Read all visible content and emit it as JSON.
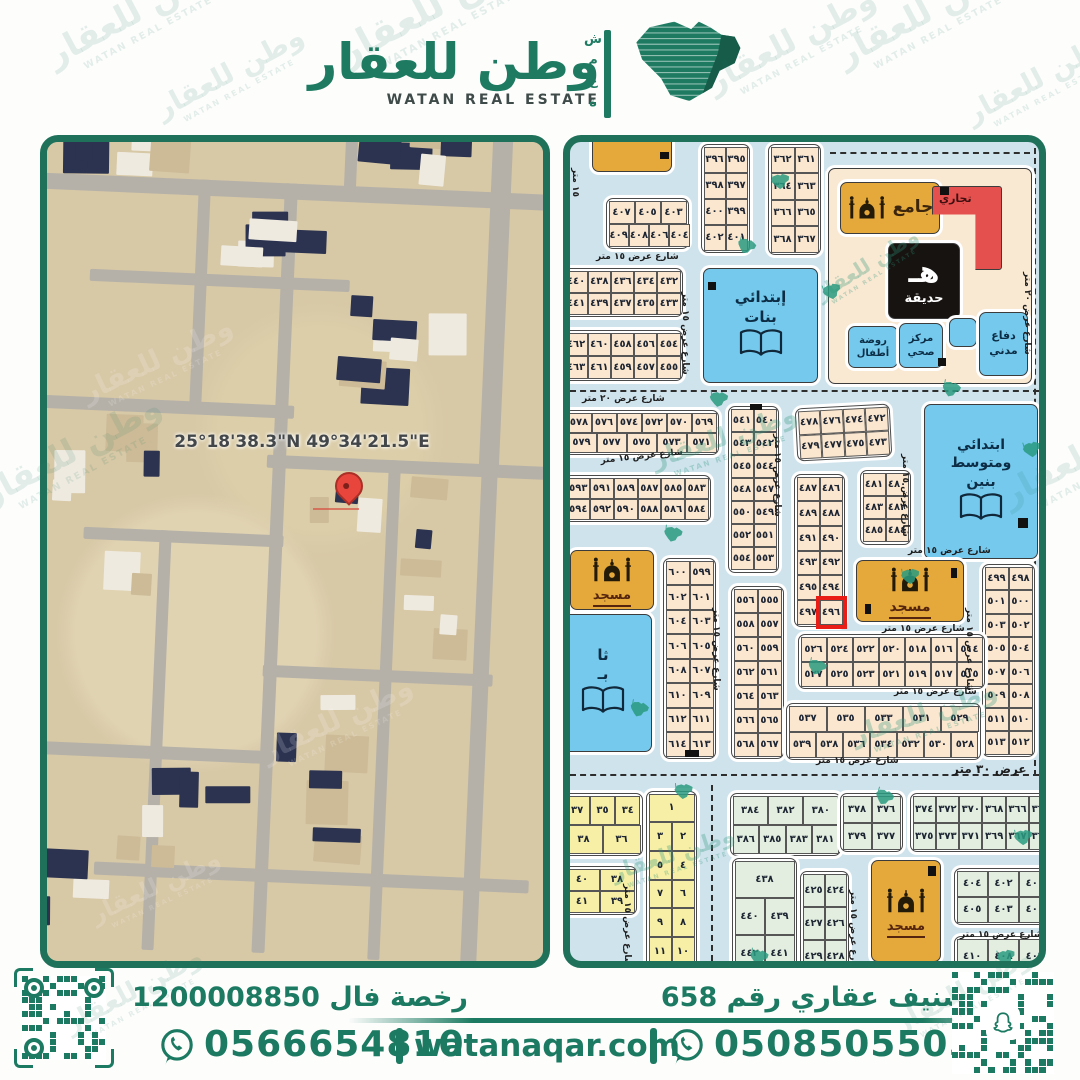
{
  "brand": {
    "name_ar": "وطن للعقار",
    "name_en": "WATAN REAL ESTATE",
    "side_letters": [
      "ش",
      "م",
      "ع",
      "ة"
    ]
  },
  "satellite": {
    "coordinates": "25°18'38.3\"N 49°34'21.5\"E"
  },
  "plot_map": {
    "highlighted_plot": "٤٩٦",
    "facilities": [
      {
        "id": "gold-top",
        "color": "gold",
        "icon": "",
        "lines": [],
        "x": 22,
        "y": -8,
        "w": 78,
        "h": 36,
        "fs": 10
      },
      {
        "id": "services-superblock",
        "color": "cream",
        "icon": "",
        "lines": [],
        "x": 258,
        "y": 26,
        "w": 202,
        "h": 214,
        "fs": 10
      },
      {
        "id": "jami",
        "color": "gold",
        "icon": "mosque",
        "row": true,
        "lines": [
          "جامع"
        ],
        "x": 270,
        "y": 40,
        "w": 98,
        "h": 50,
        "fs": 17
      },
      {
        "id": "tejari",
        "color": "red",
        "icon": "",
        "shape": "L",
        "lines": [
          "تجاري"
        ],
        "x": 362,
        "y": 44,
        "w": 62,
        "h": 76,
        "fs": 11
      },
      {
        "id": "hadiqah",
        "color": "black",
        "icon": "ha",
        "lines": [
          "حديقة"
        ],
        "x": 318,
        "y": 101,
        "w": 70,
        "h": 74,
        "fs": 13
      },
      {
        "id": "rawda",
        "color": "blue",
        "icon": "",
        "lines": [
          "روضة",
          "أطفال"
        ],
        "x": 278,
        "y": 184,
        "w": 48,
        "h": 40,
        "fs": 10
      },
      {
        "id": "markaz",
        "color": "blue",
        "icon": "",
        "lines": [
          "مركز",
          "صحي"
        ],
        "x": 329,
        "y": 181,
        "w": 42,
        "h": 43,
        "fs": 10
      },
      {
        "id": "blue-small",
        "color": "blue",
        "icon": "",
        "lines": [],
        "x": 379,
        "y": 176,
        "w": 26,
        "h": 27,
        "fs": 9
      },
      {
        "id": "difa",
        "color": "blue",
        "icon": "",
        "lines": [
          "دفاع",
          "مدني"
        ],
        "x": 409,
        "y": 170,
        "w": 47,
        "h": 62,
        "fs": 11
      },
      {
        "id": "school-banat",
        "color": "blue",
        "icon": "book",
        "lines": [
          "إبتدائي",
          "بنات"
        ],
        "x": 133,
        "y": 126,
        "w": 113,
        "h": 113,
        "fs": 15
      },
      {
        "id": "school-banin",
        "color": "blue",
        "icon": "book",
        "lines": [
          "ابتدائي",
          "ومتوسط",
          "بنين"
        ],
        "x": 354,
        "y": 262,
        "w": 112,
        "h": 153,
        "fs": 14
      },
      {
        "id": "mosque-mid",
        "color": "gold",
        "icon": "mosque",
        "lines": [
          "مسجد"
        ],
        "x": 286,
        "y": 418,
        "w": 106,
        "h": 60,
        "fs": 14
      },
      {
        "id": "mosque-left",
        "color": "gold",
        "icon": "mosque",
        "lines": [
          "مسجد"
        ],
        "x": 0,
        "y": 408,
        "w": 82,
        "h": 58,
        "fs": 13
      },
      {
        "id": "school-partial",
        "color": "blue",
        "icon": "book",
        "lines": [
          "ثا",
          "بـ"
        ],
        "x": -16,
        "y": 472,
        "w": 96,
        "h": 136,
        "fs": 15
      },
      {
        "id": "mosque-bottom",
        "color": "gold",
        "icon": "mosque",
        "lines": [
          "مسجد"
        ],
        "x": 301,
        "y": 718,
        "w": 68,
        "h": 100,
        "fs": 13
      }
    ],
    "blocks": [
      {
        "x": 36,
        "y": 56,
        "w": 78,
        "h": 46,
        "c": "cream",
        "rows": [
          [
            "٤٠٧",
            "٤٠٥",
            "٤٠٣"
          ],
          [
            "٤٠٩",
            "٤٠٨",
            "٤٠٦",
            "٤٠٤"
          ]
        ]
      },
      {
        "x": 131,
        "y": 2,
        "w": 44,
        "h": 104,
        "c": "cream",
        "rows": [
          [
            "٣٩٦",
            "٣٩٥"
          ],
          [
            "٣٩٨",
            "٣٩٧"
          ],
          [
            "٤٠٠",
            "٣٩٩"
          ],
          [
            "٤٠٢",
            "٤٠١"
          ]
        ]
      },
      {
        "x": 198,
        "y": 2,
        "w": 48,
        "h": 106,
        "c": "cream",
        "rows": [
          [
            "٣٦٢",
            "٣٦١"
          ],
          [
            "٣٦٤",
            "٣٦٣"
          ],
          [
            "٣٦٦",
            "٣٦٥"
          ],
          [
            "٣٦٨",
            "٣٦٧"
          ]
        ]
      },
      {
        "x": -8,
        "y": 126,
        "w": 116,
        "h": 44,
        "c": "cream",
        "rows": [
          [
            "٤٤٠",
            "٤٣٨",
            "٤٣٦",
            "٤٣٤",
            "٤٣٢"
          ],
          [
            "٤٤١",
            "٤٣٩",
            "٤٣٧",
            "٤٣٥",
            "٤٣٣"
          ]
        ]
      },
      {
        "x": -8,
        "y": 188,
        "w": 116,
        "h": 46,
        "c": "cream",
        "rows": [
          [
            "٤٦٢",
            "٤٦٠",
            "٤٥٨",
            "٤٥٦",
            "٤٥٤"
          ],
          [
            "٤٦٣",
            "٤٦١",
            "٤٥٩",
            "٤٥٧",
            "٤٥٥"
          ]
        ]
      },
      {
        "x": -6,
        "y": 268,
        "w": 150,
        "h": 40,
        "c": "cream",
        "rows": [
          [
            "٥٧٨",
            "٥٧٦",
            "٥٧٤",
            "٥٧٢",
            "٥٧٠",
            "٥٦٩"
          ],
          [
            "٥٧٩",
            "٥٧٧",
            "٥٧٥",
            "٥٧٣",
            "٥٧١"
          ]
        ]
      },
      {
        "x": -6,
        "y": 333,
        "w": 142,
        "h": 42,
        "c": "cream",
        "rows": [
          [
            "٥٩٣",
            "٥٩١",
            "٥٨٩",
            "٥٨٧",
            "٥٨٥",
            "٥٨٣"
          ],
          [
            "٥٩٤",
            "٥٩٢",
            "٥٩٠",
            "٥٨٨",
            "٥٨٦",
            "٥٨٤"
          ]
        ]
      },
      {
        "x": 158,
        "y": 264,
        "w": 46,
        "h": 162,
        "c": "cream",
        "rows": [
          [
            "٥٤١",
            "٥٤٠"
          ],
          [
            "٥٤٣",
            "٥٤٢"
          ],
          [
            "٥٤٥",
            "٥٤٤"
          ],
          [
            "٥٤٨",
            "٥٤٧"
          ],
          [
            "٥٥٠",
            "٥٤٩"
          ],
          [
            "٥٥٢",
            "٥٥١"
          ],
          [
            "٥٥٤",
            "٥٥٣"
          ]
        ]
      },
      {
        "x": 226,
        "y": 264,
        "w": 90,
        "h": 48,
        "c": "cream",
        "rot": -3,
        "rows": [
          [
            "٤٧٨",
            "٤٧٦",
            "٤٧٤",
            "٤٧٢"
          ],
          [
            "٤٧٩",
            "٤٧٧",
            "٤٧٥",
            "٤٧٣"
          ]
        ]
      },
      {
        "x": 290,
        "y": 328,
        "w": 46,
        "h": 70,
        "c": "cream",
        "rows": [
          [
            "٤٨١",
            "٤٨٠"
          ],
          [
            "٤٨٣",
            "٤٨٢"
          ],
          [
            "٤٨٥",
            "٤٨٤"
          ]
        ]
      },
      {
        "x": 224,
        "y": 332,
        "w": 46,
        "h": 148,
        "c": "cream",
        "hl": "٤٩٦",
        "rows": [
          [
            "٤٨٧",
            "٤٨٦"
          ],
          [
            "٤٨٩",
            "٤٨٨"
          ],
          [
            "٤٩١",
            "٤٩٠"
          ],
          [
            "٤٩٣",
            "٤٩٢"
          ],
          [
            "٤٩٥",
            "٤٩٤"
          ],
          [
            "٤٩٧",
            "٤٩٦"
          ]
        ]
      },
      {
        "x": 412,
        "y": 422,
        "w": 48,
        "h": 188,
        "c": "cream",
        "rows": [
          [
            "٤٩٩",
            "٤٩٨"
          ],
          [
            "٥٠١",
            "٥٠٠"
          ],
          [
            "٥٠٣",
            "٥٠٢"
          ],
          [
            "٥٠٥",
            "٥٠٤"
          ],
          [
            "٥٠٧",
            "٥٠٦"
          ],
          [
            "٥٠٩",
            "٥٠٨"
          ],
          [
            "٥١١",
            "٥١٠"
          ],
          [
            "٥١٣",
            "٥١٢"
          ]
        ]
      },
      {
        "x": 161,
        "y": 444,
        "w": 48,
        "h": 168,
        "c": "cream",
        "rows": [
          [
            "٥٥٦",
            "٥٥٥"
          ],
          [
            "٥٥٨",
            "٥٥٧"
          ],
          [
            "٥٦٠",
            "٥٥٩"
          ],
          [
            "٥٦٢",
            "٥٦١"
          ],
          [
            "٥٦٤",
            "٥٦٣"
          ],
          [
            "٥٦٦",
            "٥٦٥"
          ],
          [
            "٥٦٨",
            "٥٦٧"
          ]
        ]
      },
      {
        "x": 93,
        "y": 416,
        "w": 48,
        "h": 196,
        "c": "cream",
        "rows": [
          [
            "٦٠٠",
            "٥٩٩"
          ],
          [
            "٦٠٢",
            "٦٠١"
          ],
          [
            "٦٠٤",
            "٦٠٣"
          ],
          [
            "٦٠٦",
            "٦٠٥"
          ],
          [
            "٦٠٨",
            "٦٠٧"
          ],
          [
            "٦١٠",
            "٦٠٩"
          ],
          [
            "٦١٢",
            "٦١١"
          ],
          [
            "٦١٤",
            "٦١٣"
          ]
        ]
      },
      {
        "x": 228,
        "y": 492,
        "w": 182,
        "h": 50,
        "c": "cream",
        "rows": [
          [
            "٥٢٦",
            "٥٢٤",
            "٥٢٢",
            "٥٢٠",
            "٥١٨",
            "٥١٦",
            "٥١٤"
          ],
          [
            "٥٢٧",
            "٥٢٥",
            "٥٢٣",
            "٥٢١",
            "٥١٩",
            "٥١٧",
            "٥١٥"
          ]
        ]
      },
      {
        "x": 216,
        "y": 561,
        "w": 190,
        "h": 52,
        "c": "cream",
        "rows": [
          [
            "٥٣٧",
            "٥٣٥",
            "٥٣٣",
            "٥٣١",
            "٥٢٩"
          ],
          [
            "٥٣٩",
            "٥٣٨",
            "٥٣٦",
            "٥٣٤",
            "٥٣٢",
            "٥٣٠",
            "٥٢٨"
          ]
        ]
      },
      {
        "x": -8,
        "y": 651,
        "w": 76,
        "h": 58,
        "c": "yellow",
        "rows": [
          [
            "٣٧",
            "٣٥",
            "٣٤"
          ],
          [
            "٣٨",
            "٣٦"
          ]
        ]
      },
      {
        "x": -8,
        "y": 724,
        "w": 70,
        "h": 44,
        "c": "yellow",
        "rows": [
          [
            "٤٠",
            "٣٨"
          ],
          [
            "٤١",
            "٣٩"
          ]
        ]
      },
      {
        "x": 76,
        "y": 649,
        "w": 46,
        "h": 172,
        "c": "yellow",
        "rows": [
          [
            "١"
          ],
          [
            "٣",
            "٢"
          ],
          [
            "٥",
            "٤"
          ],
          [
            "٧",
            "٦"
          ],
          [
            "٩",
            "٨"
          ],
          [
            "١١",
            "١٠"
          ]
        ]
      },
      {
        "x": 160,
        "y": 651,
        "w": 106,
        "h": 58,
        "c": "green",
        "rows": [
          [
            "٣٨٤",
            "٣٨٢",
            "٣٨٠"
          ],
          [
            "٣٨٦",
            "٣٨٥",
            "٣٨٣",
            "٣٨١"
          ]
        ]
      },
      {
        "x": 270,
        "y": 651,
        "w": 58,
        "h": 54,
        "c": "green",
        "rows": [
          [
            "٣٧٨",
            "٣٧٦"
          ],
          [
            "٣٧٩",
            "٣٧٧"
          ]
        ]
      },
      {
        "x": 340,
        "y": 651,
        "w": 140,
        "h": 54,
        "c": "green",
        "rows": [
          [
            "٣٧٤",
            "٣٧٢",
            "٣٧٠",
            "٣٦٨",
            "٣٦٦",
            "٣٦٤"
          ],
          [
            "٣٧٥",
            "٣٧٣",
            "٣٧١",
            "٣٦٩",
            "٣٦٧",
            "٣٦٥"
          ]
        ]
      },
      {
        "x": 162,
        "y": 716,
        "w": 60,
        "h": 112,
        "c": "green",
        "rows": [
          [
            "٤٣٨"
          ],
          [
            "٤٤٠",
            "٤٣٩"
          ],
          [
            "٤٤٢",
            "٤٤١"
          ]
        ]
      },
      {
        "x": 230,
        "y": 729,
        "w": 44,
        "h": 100,
        "c": "green",
        "rows": [
          [
            "٤٢٥",
            "٤٢٤"
          ],
          [
            "٤٢٧",
            "٤٢٦"
          ],
          [
            "٤٢٩",
            "٤٢٨"
          ]
        ]
      },
      {
        "x": 384,
        "y": 726,
        "w": 94,
        "h": 52,
        "c": "green",
        "rows": [
          [
            "٤٠٤",
            "٤٠٢",
            "٤٠٠"
          ],
          [
            "٤٠٥",
            "٤٠٣",
            "٤٠١"
          ]
        ]
      },
      {
        "x": 384,
        "y": 794,
        "w": 94,
        "h": 36,
        "c": "green",
        "rows": [
          [
            "٤١٠",
            "٤٠٨",
            "٤٠٦"
          ]
        ]
      }
    ],
    "dashed_streets": [
      {
        "x": 0,
        "y": 248,
        "w": 469
      },
      {
        "x": 464,
        "y": 6,
        "h": 628
      },
      {
        "x": 0,
        "y": 632,
        "w": 469
      },
      {
        "x": 141,
        "y": 643,
        "h": 176
      },
      {
        "x": 260,
        "y": 10,
        "w": 200
      },
      {
        "x": 256,
        "y": 28,
        "h": 210
      }
    ],
    "street_labels": [
      {
        "t": "شارع عرض ١٥ متر",
        "x": 26,
        "y": 110,
        "r": 0
      },
      {
        "t": "١٥ متر",
        "x": 10,
        "y": 26,
        "r": 90
      },
      {
        "t": "شارع عرض ١٥ متر",
        "x": 120,
        "y": 150,
        "r": 90
      },
      {
        "t": "شارع عرض ٢٠ متر",
        "x": 12,
        "y": 252,
        "r": 0
      },
      {
        "t": "شارع عرض ٢٠ متر",
        "x": 462,
        "y": 130,
        "r": 90
      },
      {
        "t": "شارع عرض ١٥ متر",
        "x": 30,
        "y": 314,
        "r": -6
      },
      {
        "t": "شارع عرض ١٥ متر",
        "x": 212,
        "y": 292,
        "r": 90
      },
      {
        "t": "شارع عرض ١٥ متر",
        "x": 340,
        "y": 312,
        "r": 90
      },
      {
        "t": "شارع عرض ١٥ متر",
        "x": 338,
        "y": 404,
        "r": 0
      },
      {
        "t": "شارع عرض ١٥ متر",
        "x": 312,
        "y": 482,
        "r": 0
      },
      {
        "t": "شارع عرض ١٥ متر",
        "x": 324,
        "y": 545,
        "r": 0
      },
      {
        "t": "شارع عرض ١٥ متر",
        "x": 151,
        "y": 466,
        "r": 90
      },
      {
        "t": "شارع عرض ١٥ متر",
        "x": 404,
        "y": 466,
        "r": 90
      },
      {
        "t": "عرض ٣٠ متر",
        "x": 382,
        "y": 620,
        "r": 0,
        "s": 12
      },
      {
        "t": "شارع عرض ١٥ متر",
        "x": 246,
        "y": 614,
        "r": 0
      },
      {
        "t": "شارع عرض ١٥ متر",
        "x": 62,
        "y": 742,
        "r": 90
      },
      {
        "t": "شارع عرض ١٥ متر",
        "x": 288,
        "y": 748,
        "r": 90
      },
      {
        "t": "شارع عرض ١٥ متر",
        "x": 390,
        "y": 788,
        "r": 0
      }
    ],
    "marks": [
      {
        "x": 90,
        "y": 10,
        "w": 9,
        "h": 7
      },
      {
        "x": 370,
        "y": 45,
        "w": 9,
        "h": 8
      },
      {
        "x": 368,
        "y": 216,
        "w": 8,
        "h": 8
      },
      {
        "x": 138,
        "y": 140,
        "w": 8,
        "h": 8
      },
      {
        "x": 180,
        "y": 262,
        "w": 12,
        "h": 6
      },
      {
        "x": 295,
        "y": 462,
        "w": 6,
        "h": 10
      },
      {
        "x": 381,
        "y": 426,
        "w": 6,
        "h": 10
      },
      {
        "x": 448,
        "y": 376,
        "w": 10,
        "h": 10
      },
      {
        "x": 115,
        "y": 608,
        "w": 14,
        "h": 7
      },
      {
        "x": 358,
        "y": 724,
        "w": 8,
        "h": 10
      }
    ]
  },
  "footer": {
    "license": "رخصة فال 1200008850",
    "classification": "تصنيف عقاري رقم 658",
    "phone_left": "0566654810",
    "phone_right": "0508505505",
    "website": "watanaqar.com"
  },
  "colors": {
    "brand_green": "#1b7a61",
    "map_blue_bg": "#cfe3ed",
    "plot_cream": "#fbe7cf",
    "plot_yellow": "#f6efa5",
    "plot_green": "#e3eee0",
    "facility_gold": "#e4a93a",
    "facility_blue": "#74c9ed",
    "commercial_red": "#e4504e",
    "highlight_red": "#ea1c16"
  }
}
